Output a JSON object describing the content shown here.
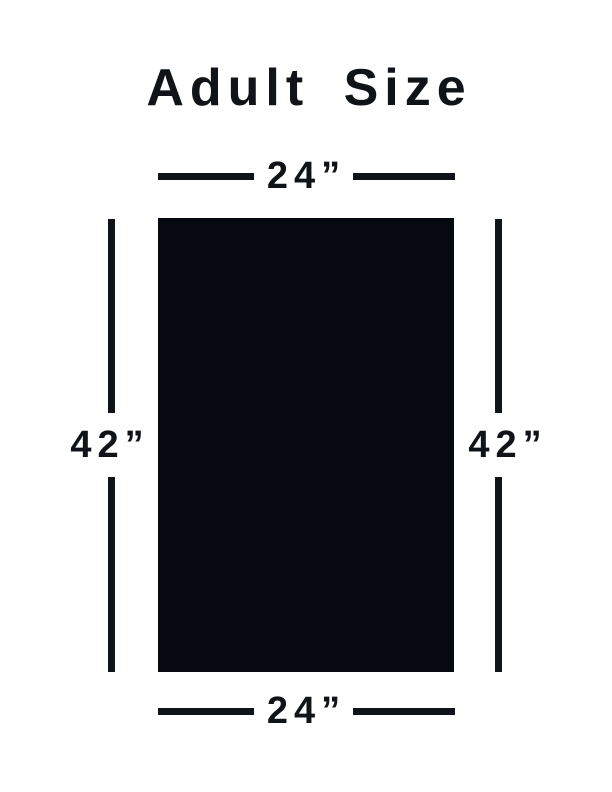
{
  "title": "Adult Size",
  "dimensions": {
    "top": "24”",
    "bottom": "24”",
    "left": "42”",
    "right": "42”"
  },
  "colors": {
    "ink": "#101318",
    "rect_fill": "#060a10",
    "background": "#ffffff"
  }
}
